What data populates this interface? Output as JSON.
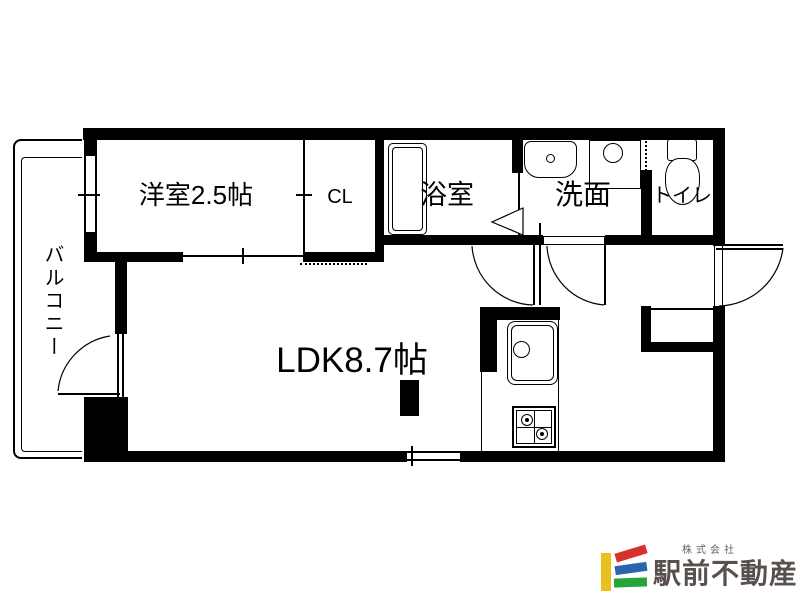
{
  "type": "floor-plan",
  "rooms": {
    "balcony": {
      "label": "バルコニー"
    },
    "western_room": {
      "label": "洋室2.5帖"
    },
    "closet": {
      "label": "CL"
    },
    "bathroom": {
      "label": "浴室"
    },
    "washroom": {
      "label": "洗面"
    },
    "toilet": {
      "label": "トイレ"
    },
    "ldk": {
      "label": "LDK8.7帖"
    }
  },
  "logo": {
    "company_prefix": "株式会社",
    "company_name": "駅前不動産",
    "colors": {
      "yellow": "#e8c11c",
      "red": "#d7312e",
      "blue": "#2b64ad",
      "green": "#27a439",
      "text": "#57504d"
    }
  }
}
